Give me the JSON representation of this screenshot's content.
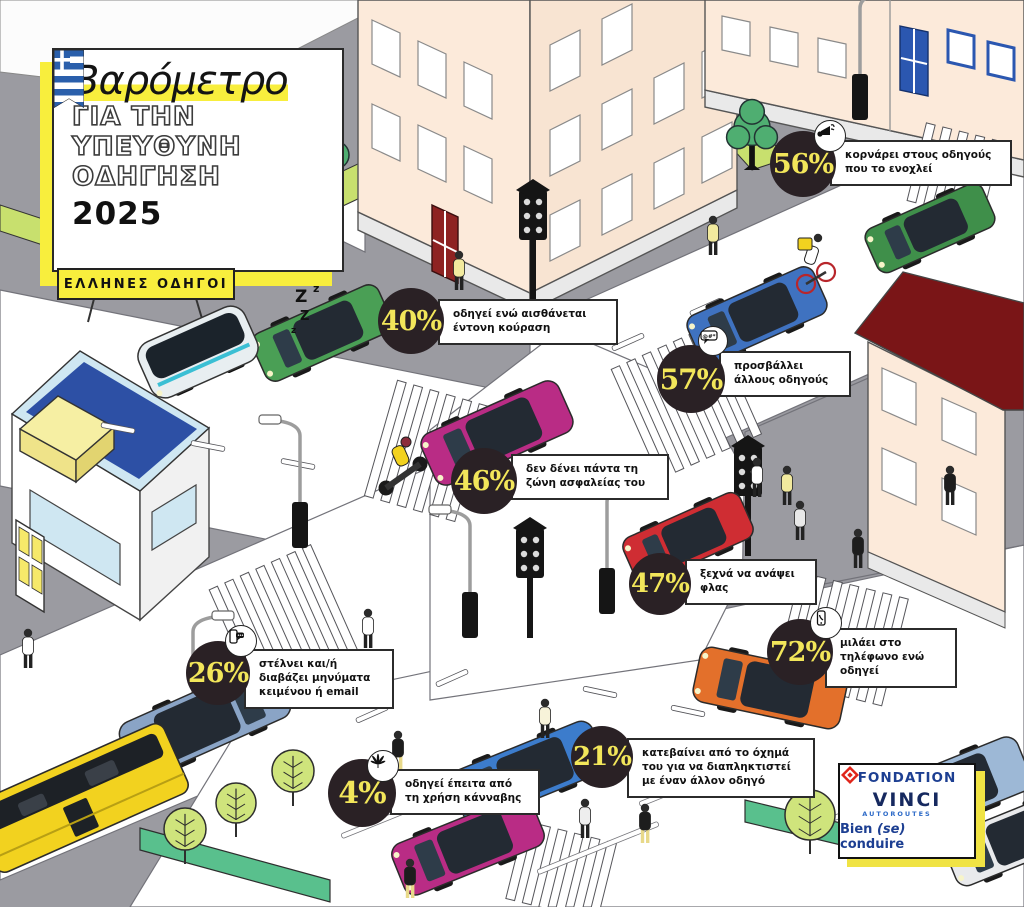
{
  "title": {
    "main": "Βαρόμετρο",
    "line2": "ΓΙΑ ΤΗΝ",
    "line3": "ΥΠΕΥΘΥΝΗ",
    "line4": "ΟΔΗΓΗΣΗ",
    "year": "2025"
  },
  "badge": {
    "label": "ΕΛΛΗΝΕΣ ΟΔΗΓΟΙ"
  },
  "callouts": [
    {
      "value": "56%",
      "text": "κορνάρει στους οδηγούς που το ενοχλεί",
      "icon": "horn-icon"
    },
    {
      "value": "40%",
      "text": "οδηγεί ενώ αισθάνεται έντονη κούραση",
      "icon": null
    },
    {
      "value": "57%",
      "text": "προσβάλλει άλλους οδηγούς",
      "icon": "insult-speech-bubble-icon"
    },
    {
      "value": "46%",
      "text": "δεν δένει πάντα τη ζώνη ασφαλείας του",
      "icon": null
    },
    {
      "value": "47%",
      "text": "ξεχνά να ανάψει φλας",
      "icon": null
    },
    {
      "value": "72%",
      "text": "μιλάει στο τηλέφωνο ενώ οδηγεί",
      "icon": "phone-call-icon"
    },
    {
      "value": "26%",
      "text": "στέλνει και/ή διαβάζει μηνύματα κειμένου ή email",
      "icon": "text-message-icon"
    },
    {
      "value": "21%",
      "text": "κατεβαίνει από το όχημά του για να διαπληκτιστεί με έναν άλλον οδηγό",
      "icon": null
    },
    {
      "value": "4%",
      "text": "οδηγεί έπειτα από τη χρήση κάνναβης",
      "icon": "cannabis-leaf-icon"
    }
  ],
  "logo": {
    "foundation": "FONDATION",
    "brand": "VINCI",
    "division": "AUTOROUTES",
    "tagline_pre": "Bien ",
    "tagline_emphasis": "(se)",
    "tagline_post": " conduire"
  },
  "scene": {
    "sleep_zzz": [
      "Z",
      "z",
      "Z",
      "z"
    ],
    "insult_symbols": "@#*!"
  },
  "colors": {
    "highlight_yellow": "#f8ee3d",
    "callout_circle": "#2a2125",
    "callout_percent": "#f2e65a",
    "flag_blue": "#2a5fab",
    "logo_blue": "#1d3f92",
    "logo_red": "#e0251b"
  }
}
